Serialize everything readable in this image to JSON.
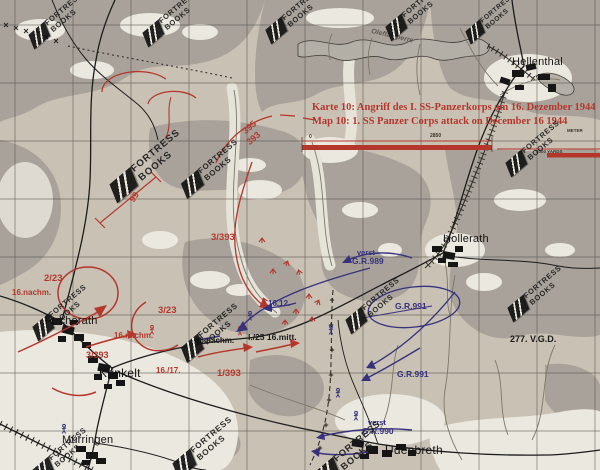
{
  "page": {
    "kind": "scanned-book-map",
    "publisher": "FORTRESS BOOKS"
  },
  "watermark": {
    "line1": "FORTRESS",
    "line2": "BOOKS"
  },
  "colors": {
    "background": "#c8c1b4",
    "forest": "#a8a29b",
    "clearing": "#ebe8df",
    "attack_red": "#b5372c",
    "movement_blue": "#38327e",
    "ink_black": "#1b1b1b",
    "water_gray": "#b4afa6"
  },
  "scale_bar": {
    "zero": "0",
    "distance": "2850",
    "unit_top": "METER",
    "unit_bottom": "3000 YARDS"
  },
  "labels": [
    {
      "name": "map-title-german",
      "cls": "title",
      "text": "Karte 10: Angriff des I. SS-Panzerkorps am 16. Dezember 1944",
      "x": 312,
      "y": 103,
      "size": 10.5
    },
    {
      "name": "map-title-english",
      "cls": "title",
      "text": "Map 10: 1. SS Panzer Corps attack on December 16 1944",
      "x": 312,
      "y": 117,
      "size": 10.5
    },
    {
      "name": "town-label-hellenthal",
      "cls": "town",
      "text": "Hellenthal",
      "x": 512,
      "y": 57,
      "size": 11
    },
    {
      "name": "town-label-hollerath",
      "cls": "town",
      "text": "Hollerath",
      "x": 443,
      "y": 234,
      "size": 11
    },
    {
      "name": "town-label-rocherath",
      "cls": "town",
      "text": "Rocherath",
      "x": 45,
      "y": 316,
      "size": 11
    },
    {
      "name": "town-label-krinkelt",
      "cls": "town",
      "text": "Krinkelt",
      "x": 99,
      "y": 367,
      "size": 12
    },
    {
      "name": "town-label-murringen",
      "cls": "town",
      "text": "Mürringen",
      "x": 62,
      "y": 435,
      "size": 11
    },
    {
      "name": "town-label-udenbreth",
      "cls": "town",
      "text": "Udenbreth",
      "x": 385,
      "y": 444,
      "size": 12
    },
    {
      "name": "water-label-oleftalsperre",
      "cls": "water",
      "text": "Oleftalsperre",
      "x": 372,
      "y": 28,
      "size": 7,
      "rot": 13
    },
    {
      "name": "red-unit-2-23",
      "cls": "red",
      "text": "2/23",
      "x": 44,
      "y": 274,
      "size": 9.5
    },
    {
      "name": "red-time-16nachm-west",
      "cls": "red",
      "text": "16.nachm.",
      "x": 12,
      "y": 289,
      "size": 8
    },
    {
      "name": "red-unit-3-23",
      "cls": "red",
      "text": "3/23",
      "x": 158,
      "y": 306,
      "size": 9.5
    },
    {
      "name": "red-time-16nachm-krinkelt",
      "cls": "red",
      "text": "16.nachm.",
      "x": 114,
      "y": 332,
      "size": 8
    },
    {
      "name": "red-unit-3-393-krinkelt",
      "cls": "red",
      "text": "3/393",
      "x": 86,
      "y": 351,
      "size": 9
    },
    {
      "name": "red-time-16-17",
      "cls": "red",
      "text": "16./17.",
      "x": 156,
      "y": 367,
      "size": 8
    },
    {
      "name": "red-unit-1-393",
      "cls": "red",
      "text": "1/393",
      "x": 217,
      "y": 369,
      "size": 9.5
    },
    {
      "name": "red-unit-3-393-north",
      "cls": "red",
      "text": "3/393",
      "x": 211,
      "y": 233,
      "size": 9.5
    },
    {
      "name": "red-boundary-395",
      "cls": "red",
      "text": "395",
      "x": 241,
      "y": 129,
      "size": 9,
      "rot": -40
    },
    {
      "name": "red-boundary-393",
      "cls": "red",
      "text": "393",
      "x": 245,
      "y": 140,
      "size": 9,
      "rot": -40
    },
    {
      "name": "red-boundary-2",
      "cls": "red",
      "text": "2",
      "x": 123,
      "y": 191,
      "size": 9,
      "rot": -57
    },
    {
      "name": "red-boundary-99",
      "cls": "red",
      "text": "99",
      "x": 128,
      "y": 199,
      "size": 9,
      "rot": -57
    },
    {
      "name": "black-time-16nachm",
      "cls": "blacku",
      "text": "16.nachm.",
      "x": 195,
      "y": 337,
      "size": 8
    },
    {
      "name": "black-unit-1-25-16mitt",
      "cls": "blacku",
      "text": "I./25  16.mitt.",
      "x": 248,
      "y": 333,
      "size": 8.5
    },
    {
      "name": "black-unit-277-vgd",
      "cls": "blacku",
      "text": "277. V.G.D.",
      "x": 510,
      "y": 335,
      "size": 9
    },
    {
      "name": "blue-verst-989",
      "cls": "blue",
      "text": "verst",
      "x": 357,
      "y": 249,
      "size": 7.5
    },
    {
      "name": "blue-unit-gr989",
      "cls": "blue",
      "text": "G.R.989",
      "x": 352,
      "y": 257,
      "size": 8.5
    },
    {
      "name": "blue-unit-gr991-ellipse",
      "cls": "blue",
      "text": "G.R.991",
      "x": 395,
      "y": 302,
      "size": 8.5
    },
    {
      "name": "blue-unit-gr991-arrow",
      "cls": "blue",
      "text": "G.R.991",
      "x": 397,
      "y": 370,
      "size": 8.5
    },
    {
      "name": "blue-time-16-12",
      "cls": "blue",
      "text": "16.12.",
      "x": 268,
      "y": 300,
      "size": 8
    },
    {
      "name": "blue-verst-990",
      "cls": "blue",
      "text": "verst",
      "x": 368,
      "y": 419,
      "size": 7.5
    },
    {
      "name": "blue-unit-gr990",
      "cls": "blue",
      "text": "G.R.990",
      "x": 362,
      "y": 427,
      "size": 8.5
    },
    {
      "name": "scale-zero",
      "cls": "scale",
      "text": "0",
      "x": 309,
      "y": 135,
      "size": 5
    },
    {
      "name": "scale-distance",
      "cls": "scale",
      "text": "2850",
      "x": 430,
      "y": 134,
      "size": 5
    },
    {
      "name": "scale-unit-meter",
      "cls": "scale",
      "text": "METER",
      "x": 567,
      "y": 129,
      "size": 4.5
    },
    {
      "name": "scale-unit-yards",
      "cls": "scale",
      "text": "3000 YARDS",
      "x": 536,
      "y": 150,
      "size": 4.5
    }
  ],
  "watermarks": [
    {
      "x": 58,
      "y": 20,
      "s": 1
    },
    {
      "x": 172,
      "y": 18,
      "s": 1
    },
    {
      "x": 295,
      "y": 15,
      "s": 1
    },
    {
      "x": 415,
      "y": 12,
      "s": 1
    },
    {
      "x": 492,
      "y": 18,
      "s": 0.9
    },
    {
      "x": 148,
      "y": 165,
      "s": 1.3
    },
    {
      "x": 212,
      "y": 168,
      "s": 1.05
    },
    {
      "x": 535,
      "y": 148,
      "s": 1
    },
    {
      "x": 62,
      "y": 312,
      "s": 1
    },
    {
      "x": 212,
      "y": 332,
      "s": 1.05
    },
    {
      "x": 375,
      "y": 305,
      "s": 1
    },
    {
      "x": 537,
      "y": 293,
      "s": 1
    },
    {
      "x": 62,
      "y": 455,
      "s": 1
    },
    {
      "x": 205,
      "y": 447,
      "s": 1.1
    },
    {
      "x": 350,
      "y": 455,
      "s": 1.25
    }
  ]
}
